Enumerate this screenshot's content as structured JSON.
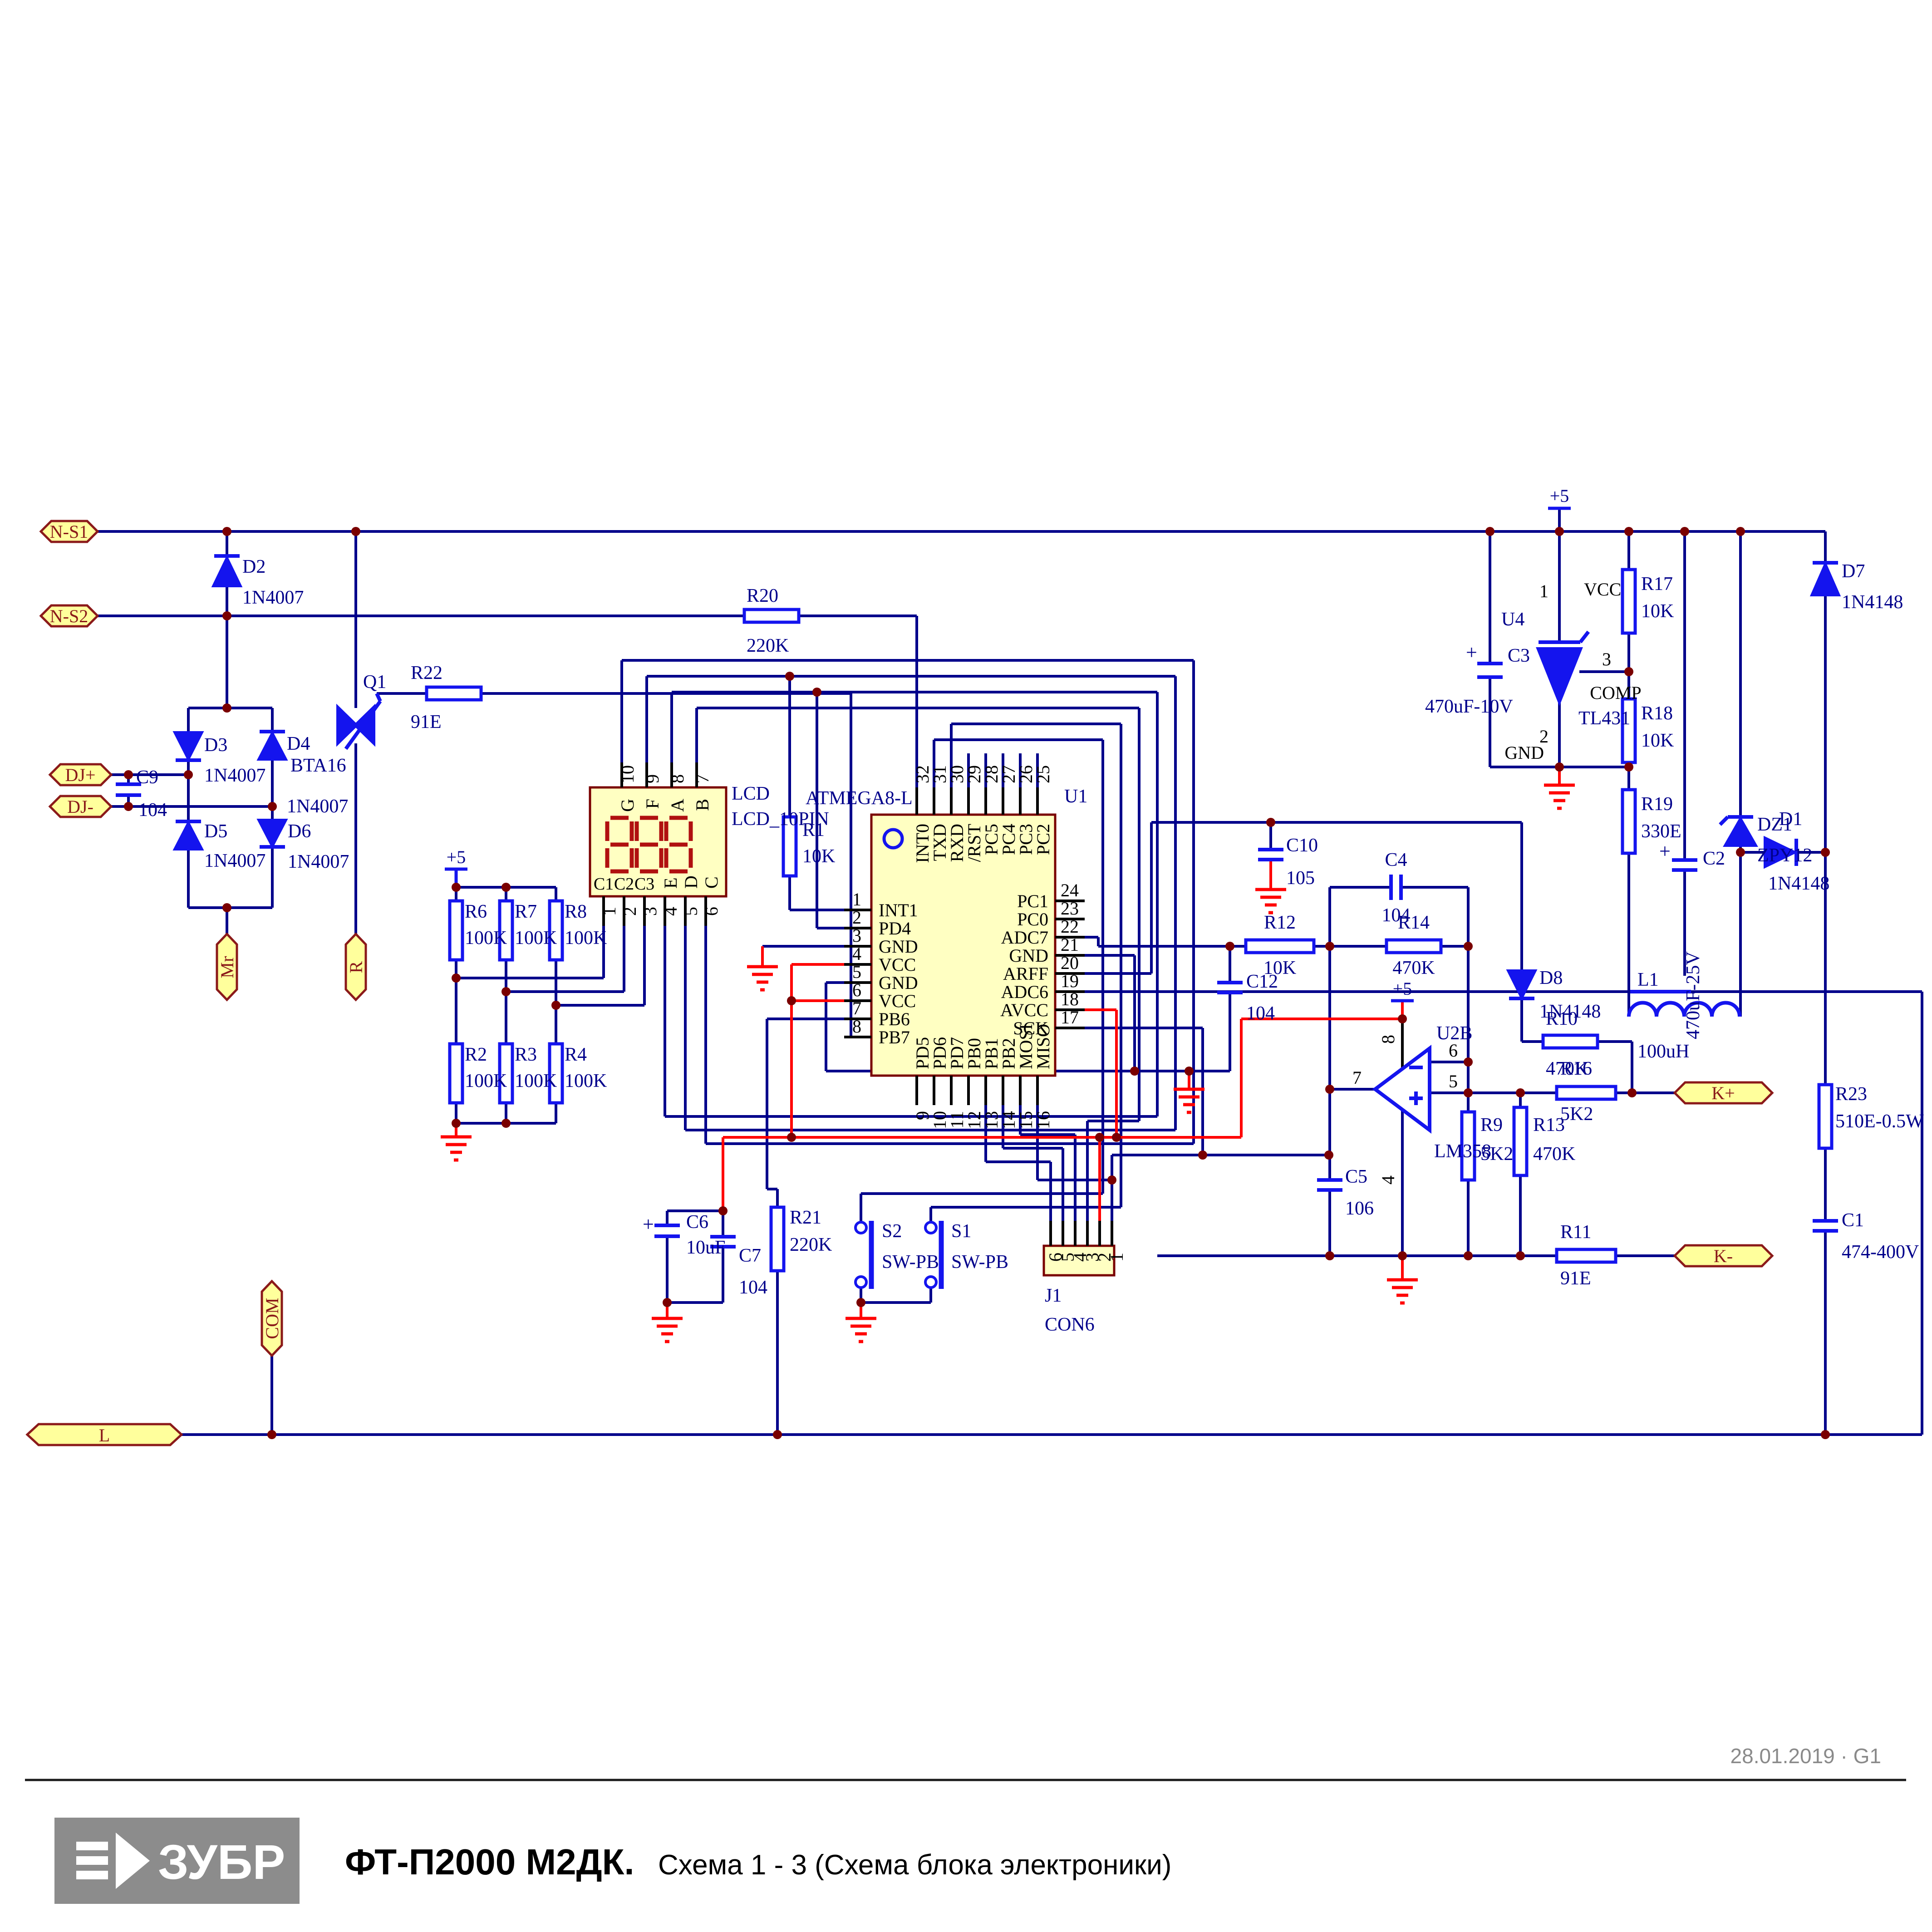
{
  "connectors": {
    "ns1": "N-S1",
    "ns2": "N-S2",
    "djp": "DJ+",
    "djm": "DJ-",
    "mr": "Mr",
    "r": "R",
    "com": "COM",
    "l": "L",
    "kp": "K+",
    "km": "K-"
  },
  "power": {
    "p5": "+5"
  },
  "components": {
    "D1": {
      "ref": "D1",
      "val": "1N4148"
    },
    "D2": {
      "ref": "D2",
      "val": "1N4007"
    },
    "D3": {
      "ref": "D3",
      "val": "1N4007"
    },
    "D4": {
      "ref": "D4",
      "val": "1N4007"
    },
    "D5": {
      "ref": "D5",
      "val": "1N4007"
    },
    "D6": {
      "ref": "D6",
      "val": "1N4007"
    },
    "D7": {
      "ref": "D7",
      "val": "1N4148"
    },
    "D8": {
      "ref": "D8",
      "val": "1N4148"
    },
    "DZ1": {
      "ref": "DZ1",
      "val": "ZPY12"
    },
    "Q1": {
      "ref": "Q1",
      "val": "BTA16"
    },
    "L1": {
      "ref": "L1",
      "val": "100uH"
    },
    "C1": {
      "ref": "C1",
      "val": "474-400V"
    },
    "C2": {
      "ref": "C2",
      "val": "470uF-25V"
    },
    "C3": {
      "ref": "C3",
      "val": "470uF-10V"
    },
    "C4": {
      "ref": "C4",
      "val": "104"
    },
    "C5": {
      "ref": "C5",
      "val": "106"
    },
    "C6": {
      "ref": "C6",
      "val": "10uF"
    },
    "C7": {
      "ref": "C7",
      "val": "104"
    },
    "C9": {
      "ref": "C9",
      "val": "104"
    },
    "C10": {
      "ref": "C10",
      "val": "105"
    },
    "C12": {
      "ref": "C12",
      "val": "104"
    },
    "R1": {
      "ref": "R1",
      "val": "10K"
    },
    "R2": {
      "ref": "R2",
      "val": "100K"
    },
    "R3": {
      "ref": "R3",
      "val": "100K"
    },
    "R4": {
      "ref": "R4",
      "val": "100K"
    },
    "R6": {
      "ref": "R6",
      "val": "100K"
    },
    "R7": {
      "ref": "R7",
      "val": "100K"
    },
    "R8": {
      "ref": "R8",
      "val": "100K"
    },
    "R9": {
      "ref": "R9",
      "val": "5K2"
    },
    "R10": {
      "ref": "R10",
      "val": "470K"
    },
    "R11": {
      "ref": "R11",
      "val": "91E"
    },
    "R12": {
      "ref": "R12",
      "val": "10K"
    },
    "R13": {
      "ref": "R13",
      "val": "470K"
    },
    "R14": {
      "ref": "R14",
      "val": "470K"
    },
    "R16": {
      "ref": "R16",
      "val": "5K2"
    },
    "R17": {
      "ref": "R17",
      "val": "10K"
    },
    "R18": {
      "ref": "R18",
      "val": "10K"
    },
    "R19": {
      "ref": "R19",
      "val": "330E"
    },
    "R20": {
      "ref": "R20",
      "val": "220K"
    },
    "R21": {
      "ref": "R21",
      "val": "220K"
    },
    "R22": {
      "ref": "R22",
      "val": "91E"
    },
    "R23": {
      "ref": "R23",
      "val": "510E-0.5W"
    },
    "S1": {
      "ref": "S1",
      "val": "SW-PB"
    },
    "S2": {
      "ref": "S2",
      "val": "SW-PB"
    }
  },
  "ics": {
    "U1": {
      "ref": "U1",
      "part": "ATMEGA8-L",
      "top_nums": [
        "32",
        "31",
        "30",
        "29",
        "28",
        "27",
        "26",
        "25"
      ],
      "top_labels": [
        "INT0",
        "TXD",
        "RXD",
        "/RST",
        "PC5",
        "PC4",
        "PC3",
        "PC2"
      ],
      "left_nums": [
        "1",
        "2",
        "3",
        "4",
        "5",
        "6",
        "7",
        "8"
      ],
      "left_labels": [
        "INT1",
        "PD4",
        "GND",
        "VCC",
        "GND",
        "VCC",
        "PB6",
        "PB7"
      ],
      "right_nums": [
        "24",
        "23",
        "22",
        "21",
        "20",
        "19",
        "18",
        "17"
      ],
      "right_labels": [
        "PC1",
        "PC0",
        "ADC7",
        "GND",
        "ARFF",
        "ADC6",
        "AVCC",
        "SCK"
      ],
      "bottom_nums": [
        "9",
        "10",
        "11",
        "12",
        "13",
        "14",
        "15",
        "16"
      ],
      "bottom_labels": [
        "PD5",
        "PD6",
        "PD7",
        "PB0",
        "PB1",
        "PB2",
        "MOSI",
        "MISO"
      ]
    },
    "LCD": {
      "ref": "LCD",
      "part": "LCD_10PIN",
      "top_nums": [
        "10",
        "9",
        "8",
        "7"
      ],
      "top_labels": [
        "G",
        "F",
        "A",
        "B"
      ],
      "bottom_nums": [
        "1",
        "2",
        "3",
        "4",
        "5",
        "6"
      ],
      "bottom_cc": [
        "C1",
        "C2",
        "C3"
      ],
      "bottom_letters": [
        "E",
        "D",
        "C"
      ]
    },
    "U2B": {
      "ref": "U2B",
      "part": "LM358",
      "pin_out": "7",
      "pin_minus": "6",
      "pin_plus": "5",
      "pin_vcc": "8",
      "pin_gnd": "4"
    },
    "U4": {
      "ref": "U4",
      "part": "TL431",
      "pin1": "1",
      "pin1_label": "VCC",
      "pin2": "2",
      "pin2_label": "GND",
      "pin3": "3",
      "pin3_label": "COMP"
    },
    "J1": {
      "ref": "J1",
      "part": "CON6",
      "nums": [
        "6",
        "5",
        "4",
        "3",
        "2",
        "1"
      ]
    }
  },
  "footer": {
    "logo_text": "ЗУБР",
    "title_model": "ФТ-П2000 М2ДК.",
    "title_sub": "Схема 1 - 3 (Схема блока электроники)",
    "date_note": "28.01.2019 · G1"
  },
  "colors": {
    "wire": "#00008B",
    "component": "#1414EE",
    "label": "#00008B",
    "junction": "#7A0000",
    "ground": "#FF0000",
    "vcc_wire": "#FF0000",
    "ic_fill": "#FFFFC2",
    "flag_fill": "#FFFF9C",
    "flag_border": "#8B1A1A",
    "segment": "#B01010",
    "date": "#8A8A8A",
    "logo_bg": "#8C8C8C"
  }
}
